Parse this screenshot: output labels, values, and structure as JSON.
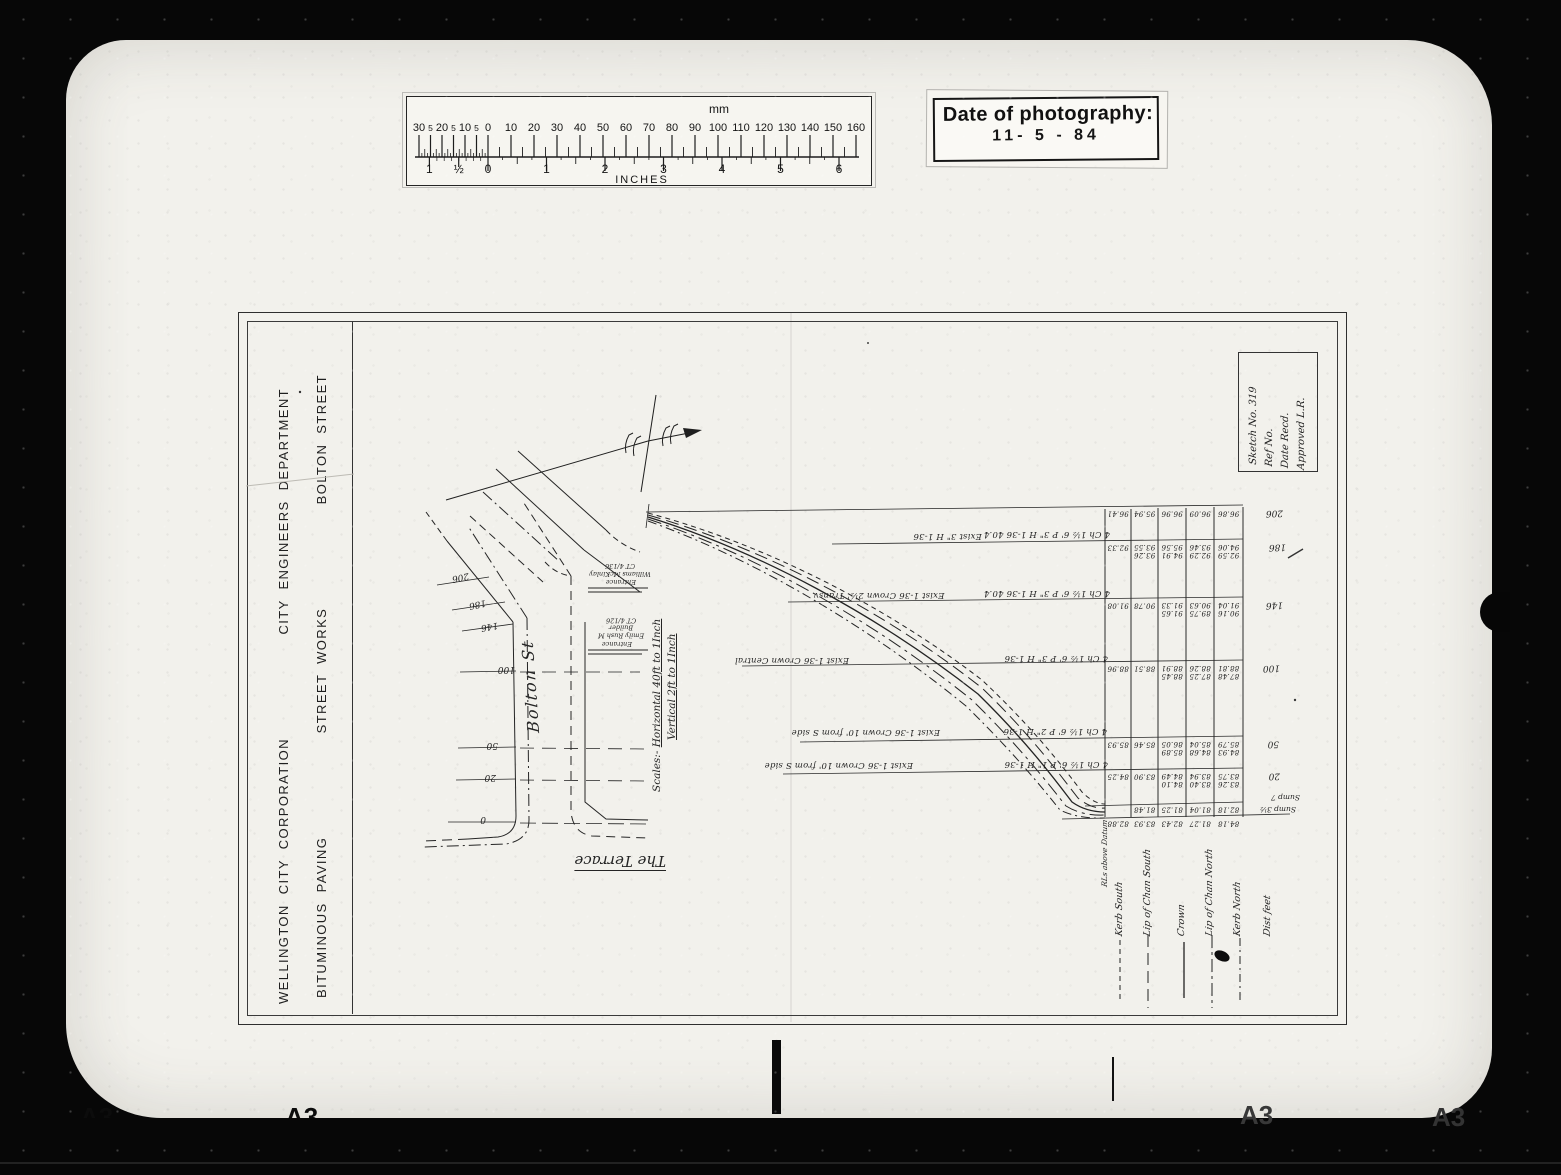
{
  "photo": {
    "stamp": {
      "title": "Date of photography:",
      "date": "11- 5 - 84"
    },
    "ruler": {
      "top_unit": "mm",
      "bottom_unit": "INCHES",
      "mm_left_labels": [
        "30",
        "5",
        "20",
        "5",
        "10",
        "5"
      ],
      "mm_right_labels": [
        "0",
        "10",
        "20",
        "30",
        "40",
        "50",
        "60",
        "70",
        "80",
        "90",
        "100",
        "110",
        "120",
        "130",
        "140",
        "150",
        "160"
      ],
      "inch_left_labels": [
        "1",
        "½"
      ],
      "inch_right_labels": [
        "0",
        "1",
        "2",
        "3",
        "4",
        "5",
        "6"
      ]
    },
    "film_frame_marks": [
      "A3",
      "A3",
      "A3",
      "A3"
    ]
  },
  "sheet": {
    "title_block": {
      "organisation": "WELLINGTON CITY CORPORATION",
      "department": "CITY ENGINEERS DEPARTMENT",
      "work_type": "BITUMINOUS PAVING",
      "works": "STREET WORKS",
      "street": "BOLTON STREET"
    },
    "sketch_box": {
      "lines": [
        "Sketch No. 319",
        "Ref No.",
        "Date Recd.",
        "Approved  L.R."
      ]
    },
    "plan": {
      "street_label": "Bolton St",
      "terrace_label": "The Terrace",
      "chainage_labels": [
        "206",
        "186",
        "146",
        "100",
        "50",
        "20",
        "0"
      ],
      "scale_label_intro": "Scales:-",
      "scale_line_1": "Horizontal 40ft to 1Inch",
      "scale_line_2": "Vertical 2ft to 1Inch",
      "lot_labels": [
        [
          "Williams McKinlay",
          "CT 4/136"
        ],
        [
          "Emily Rush M Builder",
          "CT 4/126"
        ]
      ],
      "entrance_labels": [
        "Entrance",
        "Entrance"
      ]
    },
    "profile": {
      "section_notes": [
        {
          "exist": "Exist 3\" H 1-36",
          "proposed": "4 Ch 1½ 6' P 3\" H 1-36    40.4"
        },
        {
          "exist": "Exist 1-36 Crown 2½' Transv",
          "proposed": "4 Ch 1½ 6' P 3\" H 1-36    40.4"
        },
        {
          "exist": "Exist 1-36 Crown Central",
          "proposed": "4 Ch 1½ 6' P 3\" H 1-36"
        },
        {
          "exist": "Exist 1-36 Crown 10' from S side",
          "proposed": "4 Ch 1½ 6' P 2\" H 1-36"
        },
        {
          "exist": "Exist 1-36 Crown 10' from S side",
          "proposed": "4 Ch 1½ 6' P 1\" H 1-36"
        }
      ],
      "levels_unit_label": "RLs above Datum",
      "sump_notes": [
        "Sump 7",
        "Sump 3½"
      ],
      "distance_labels": [
        "206",
        "186",
        "146",
        "100",
        "50",
        "20"
      ],
      "legend": [
        {
          "label": "Kerb  South"
        },
        {
          "label": "Lip of Chan South"
        },
        {
          "label": "Crown"
        },
        {
          "label": "Lip of Chan North"
        },
        {
          "label": "Kerb North"
        },
        {
          "label": "Dist  feet"
        }
      ],
      "table_rows": [
        {
          "dist": "206",
          "cells": [
            [
              "96.41"
            ],
            [
              "95.94"
            ],
            [
              "96.96"
            ],
            [
              "96.09"
            ],
            [
              "96.86"
            ]
          ]
        },
        {
          "dist": "186",
          "cells": [
            [
              "92.33"
            ],
            [
              "93.26",
              "93.55"
            ],
            [
              "94.91",
              "95.56"
            ],
            [
              "92.29",
              "93.46"
            ],
            [
              "92.59",
              "94.06"
            ]
          ]
        },
        {
          "dist": "146",
          "cells": [
            [
              "91.08"
            ],
            [
              "90.78"
            ],
            [
              "91.65",
              "91.33"
            ],
            [
              "89.75",
              "90.63"
            ],
            [
              "90.16",
              "91.04"
            ]
          ]
        },
        {
          "dist": "100",
          "cells": [
            [
              "88.96"
            ],
            [
              "88.51"
            ],
            [
              "88.45",
              "88.91"
            ],
            [
              "87.25",
              "88.26"
            ],
            [
              "87.48",
              "88.81"
            ]
          ]
        },
        {
          "dist": "50",
          "cells": [
            [
              "85.93"
            ],
            [
              "85.46"
            ],
            [
              "85.89",
              "86.05"
            ],
            [
              "84.68",
              "85.04"
            ],
            [
              "84.93",
              "85.79"
            ]
          ]
        },
        {
          "dist": "20",
          "cells": [
            [
              "84.25"
            ],
            [
              "83.90"
            ],
            [
              "84.10",
              "84.49"
            ],
            [
              "83.40",
              "83.94"
            ],
            [
              "83.26",
              "83.75"
            ]
          ]
        },
        {
          "dist": "",
          "cells": [
            [
              ""
            ],
            [
              "81.48"
            ],
            [
              "81.25"
            ],
            [
              "81.04"
            ],
            [
              "82.18"
            ]
          ]
        },
        {
          "dist": "",
          "cells": [
            [
              "82.88"
            ],
            [
              "83.93"
            ],
            [
              "82.43"
            ],
            [
              "81.27"
            ],
            [
              "84.18"
            ]
          ]
        }
      ]
    }
  }
}
